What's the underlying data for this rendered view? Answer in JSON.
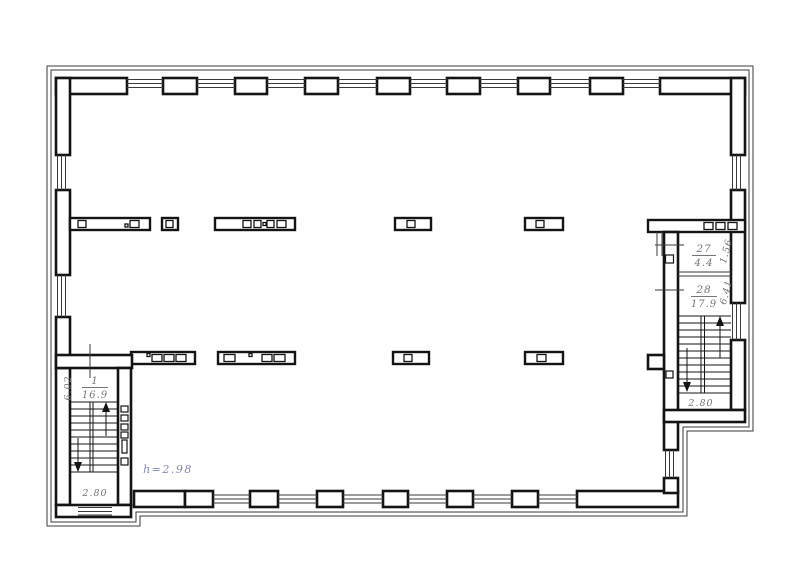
{
  "drawing": {
    "type": "architectural-floor-plan",
    "background": "#ffffff",
    "wall_color": "#141414",
    "thin_line_color": "#3a3a3a",
    "label_color": "#75757f",
    "note_color": "#8288b4"
  },
  "rooms": [
    {
      "number": "1",
      "area": "16.9"
    },
    {
      "number": "27",
      "area": "4.4"
    },
    {
      "number": "28",
      "area": "17.9"
    }
  ],
  "dimensions": {
    "stair_left_width": "6.02",
    "stair_left_landing": "2.80",
    "room27_depth": "1.56",
    "room28_depth": "6.41",
    "stair_right_landing": "2.80"
  },
  "notes": {
    "ceiling_height": "h=2.98"
  }
}
